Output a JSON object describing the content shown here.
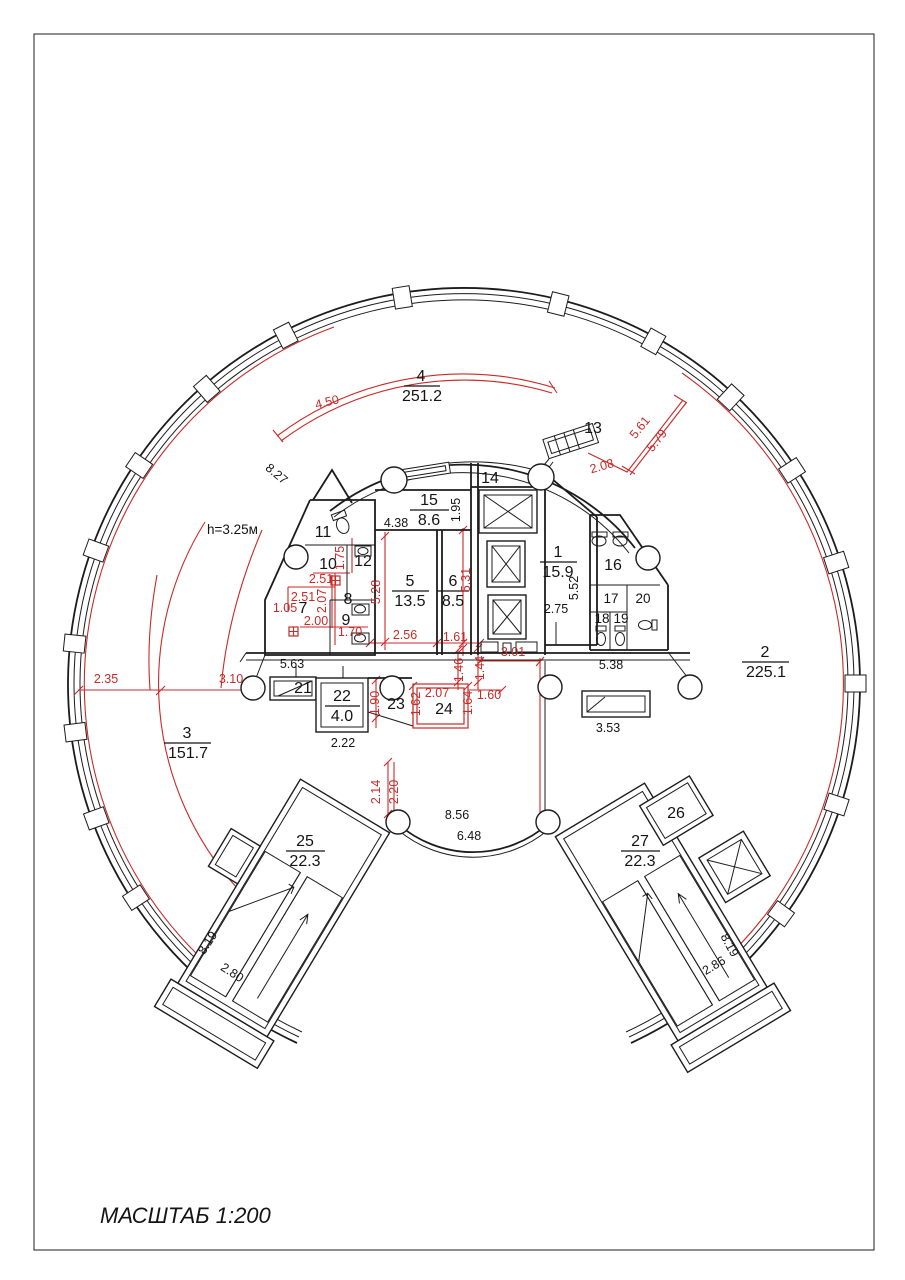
{
  "drawing": {
    "scale_label": "МАСШТАБ 1:200",
    "height_note": "h=3.25м"
  },
  "colors": {
    "wall": "#1c1c1c",
    "dimension": "#c92a28"
  },
  "rooms": [
    {
      "num": "1",
      "area": "15.9"
    },
    {
      "num": "2",
      "area": "225.1"
    },
    {
      "num": "3",
      "area": "151.7"
    },
    {
      "num": "4",
      "area": "251.2"
    },
    {
      "num": "5",
      "area": "13.5"
    },
    {
      "num": "6",
      "area": "8.5"
    },
    {
      "num": "7"
    },
    {
      "num": "8"
    },
    {
      "num": "9"
    },
    {
      "num": "10"
    },
    {
      "num": "11"
    },
    {
      "num": "12"
    },
    {
      "num": "13"
    },
    {
      "num": "14"
    },
    {
      "num": "15",
      "area": "8.6"
    },
    {
      "num": "16"
    },
    {
      "num": "17"
    },
    {
      "num": "18"
    },
    {
      "num": "19"
    },
    {
      "num": "20"
    },
    {
      "num": "21"
    },
    {
      "num": "22",
      "area": "4.0"
    },
    {
      "num": "23"
    },
    {
      "num": "24"
    },
    {
      "num": "25",
      "area": "22.3"
    },
    {
      "num": "26"
    },
    {
      "num": "27",
      "area": "22.3"
    }
  ],
  "dimensions": {
    "black": {
      "b438": "4.38",
      "b195": "1.95",
      "b552": "5.52",
      "b275": "2.75",
      "b563": "5.63",
      "b222": "2.22",
      "b538": "5.38",
      "b353": "3.53",
      "b856": "8.56",
      "b648": "6.48",
      "b827": "8.27",
      "b280": "2.80",
      "b819L": "8.19",
      "b286": "2.86",
      "b819R": "8.19"
    },
    "red": {
      "r450": "4.50",
      "r561": "5.61",
      "r579": "5.79",
      "r208": "2.08",
      "r235": "2.35",
      "r310": "3.10",
      "r251a": "2.51",
      "r251b": "2.51",
      "r207a": "2.07",
      "r175": "1.75",
      "r105": "1.05",
      "r200": "2.00",
      "r170": "1.70",
      "r528": "5.28",
      "r531": "5.31",
      "r256": "2.56",
      "r161": "1.61",
      "r146": "1.46",
      "r144": "1.44",
      "r301": "3.01",
      "r190": "1.90",
      "r162": "1.62",
      "r207b": "2.07",
      "r164": "1.64",
      "r160": "1.60",
      "r214": "2.14",
      "r220": "2.20"
    }
  }
}
